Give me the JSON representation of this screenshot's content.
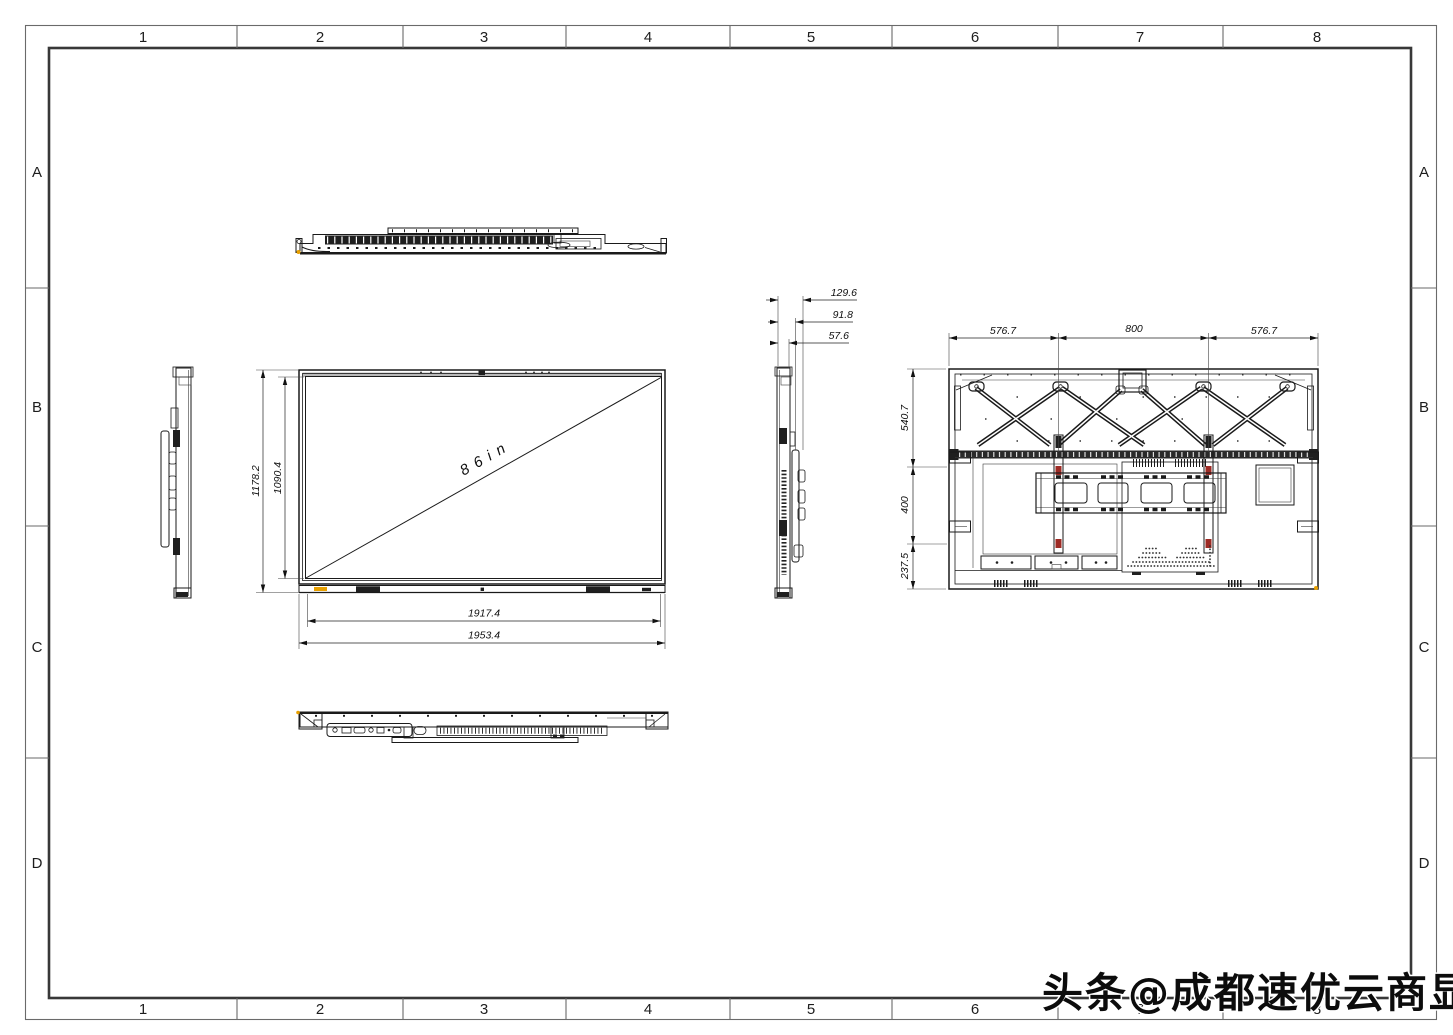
{
  "grid": {
    "columns": [
      "1",
      "2",
      "3",
      "4",
      "5",
      "6",
      "7",
      "8"
    ],
    "rows": [
      "A",
      "B",
      "C",
      "D"
    ]
  },
  "watermark": {
    "text": "头条@成都速优云商显"
  },
  "front_view": {
    "diagonal_size_label": "86in",
    "dims": {
      "overall_height": "1178.2",
      "active_height": "1090.4",
      "active_width": "1917.4",
      "overall_width": "1953.4"
    }
  },
  "side_view": {
    "dims": {
      "overall_depth": "129.6",
      "mount_depth": "91.8",
      "body_depth": "57.6"
    }
  },
  "rear_view": {
    "dims": {
      "top_left_span": "576.7",
      "top_center_span": "800",
      "top_right_span": "576.7",
      "upper_height": "540.7",
      "vesa_height": "400",
      "lower_height": "237.5"
    }
  },
  "colors": {
    "line": "#1a1a1a",
    "corner_marker": "#e8a000",
    "rail_marker": "#9e2b25"
  }
}
